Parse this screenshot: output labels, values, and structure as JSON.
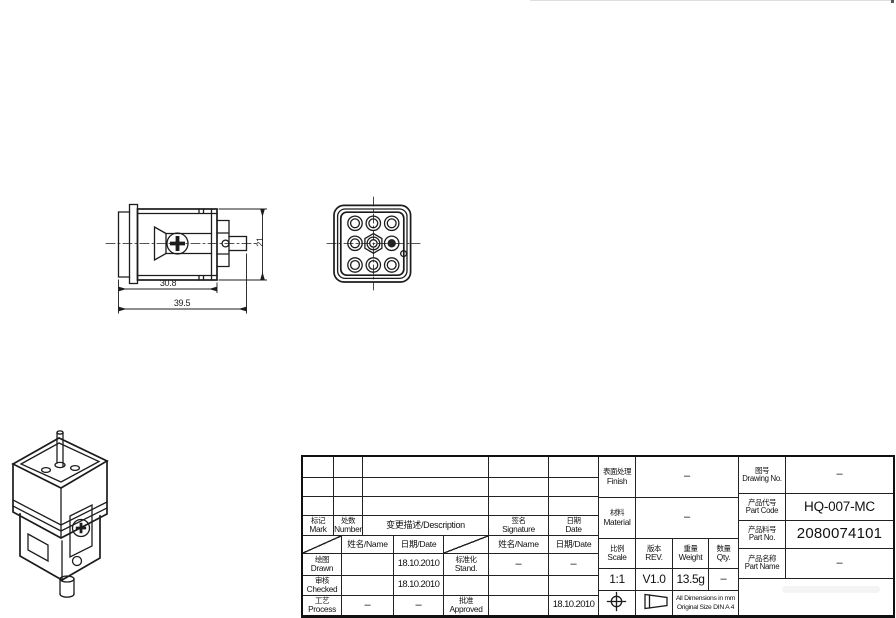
{
  "colors": {
    "line": "#1c1c1c",
    "background": "#ffffff"
  },
  "drawing": {
    "dimensions": {
      "inner_width": "30.8",
      "total_width": "39.5",
      "height": "21"
    }
  },
  "revision_table": {
    "mark_cn": "标记",
    "mark_en": "Mark",
    "number_cn": "处数",
    "number_en": "Number",
    "description": "变更描述/Description",
    "signature_cn": "签名",
    "signature_en": "Signature",
    "date_cn": "日期",
    "date_en": "Date"
  },
  "signoff": {
    "name_label": "姓名/Name",
    "date_label": "日期/Date",
    "drawn_cn": "绘图",
    "drawn_en": "Drawn",
    "drawn_date": "18.10.2010",
    "checked_cn": "审核",
    "checked_en": "Checked",
    "checked_date": "18.10.2010",
    "process_cn": "工艺",
    "process_en": "Process",
    "process_name": "–",
    "process_date": "–",
    "stand_cn": "标准化",
    "stand_en": "Stand.",
    "stand_name": "–",
    "stand_date": "–",
    "approved_cn": "批准",
    "approved_en": "Approved",
    "approved_date": "18.10.2010"
  },
  "info": {
    "finish_cn": "表面处理",
    "finish_en": "Finish",
    "finish_value": "–",
    "material_cn": "材料",
    "material_en": "Material",
    "material_value": "–",
    "scale_cn": "比例",
    "scale_en": "Scale",
    "scale_value": "1:1",
    "rev_cn": "版本",
    "rev_en": "REV.",
    "rev_value": "V1.0",
    "weight_cn": "重量",
    "weight_en": "Weight",
    "weight_value": "13.5g",
    "qty_cn": "数量",
    "qty_en": "Qty.",
    "qty_value": "–",
    "note_line1": "All Dimensions in mm",
    "note_line2": "Original Size DIN A 4"
  },
  "part_info": {
    "drawing_no_cn": "图号",
    "drawing_no_en": "Drawing No.",
    "drawing_no_value": "–",
    "part_code_cn": "产品代号",
    "part_code_en": "Part Code",
    "part_code_value": "HQ-007-MC",
    "part_no_cn": "产品料号",
    "part_no_en": "Part No.",
    "part_no_value": "2080074101",
    "part_name_cn": "产品名称",
    "part_name_en": "Part Name",
    "part_name_value": "–"
  }
}
